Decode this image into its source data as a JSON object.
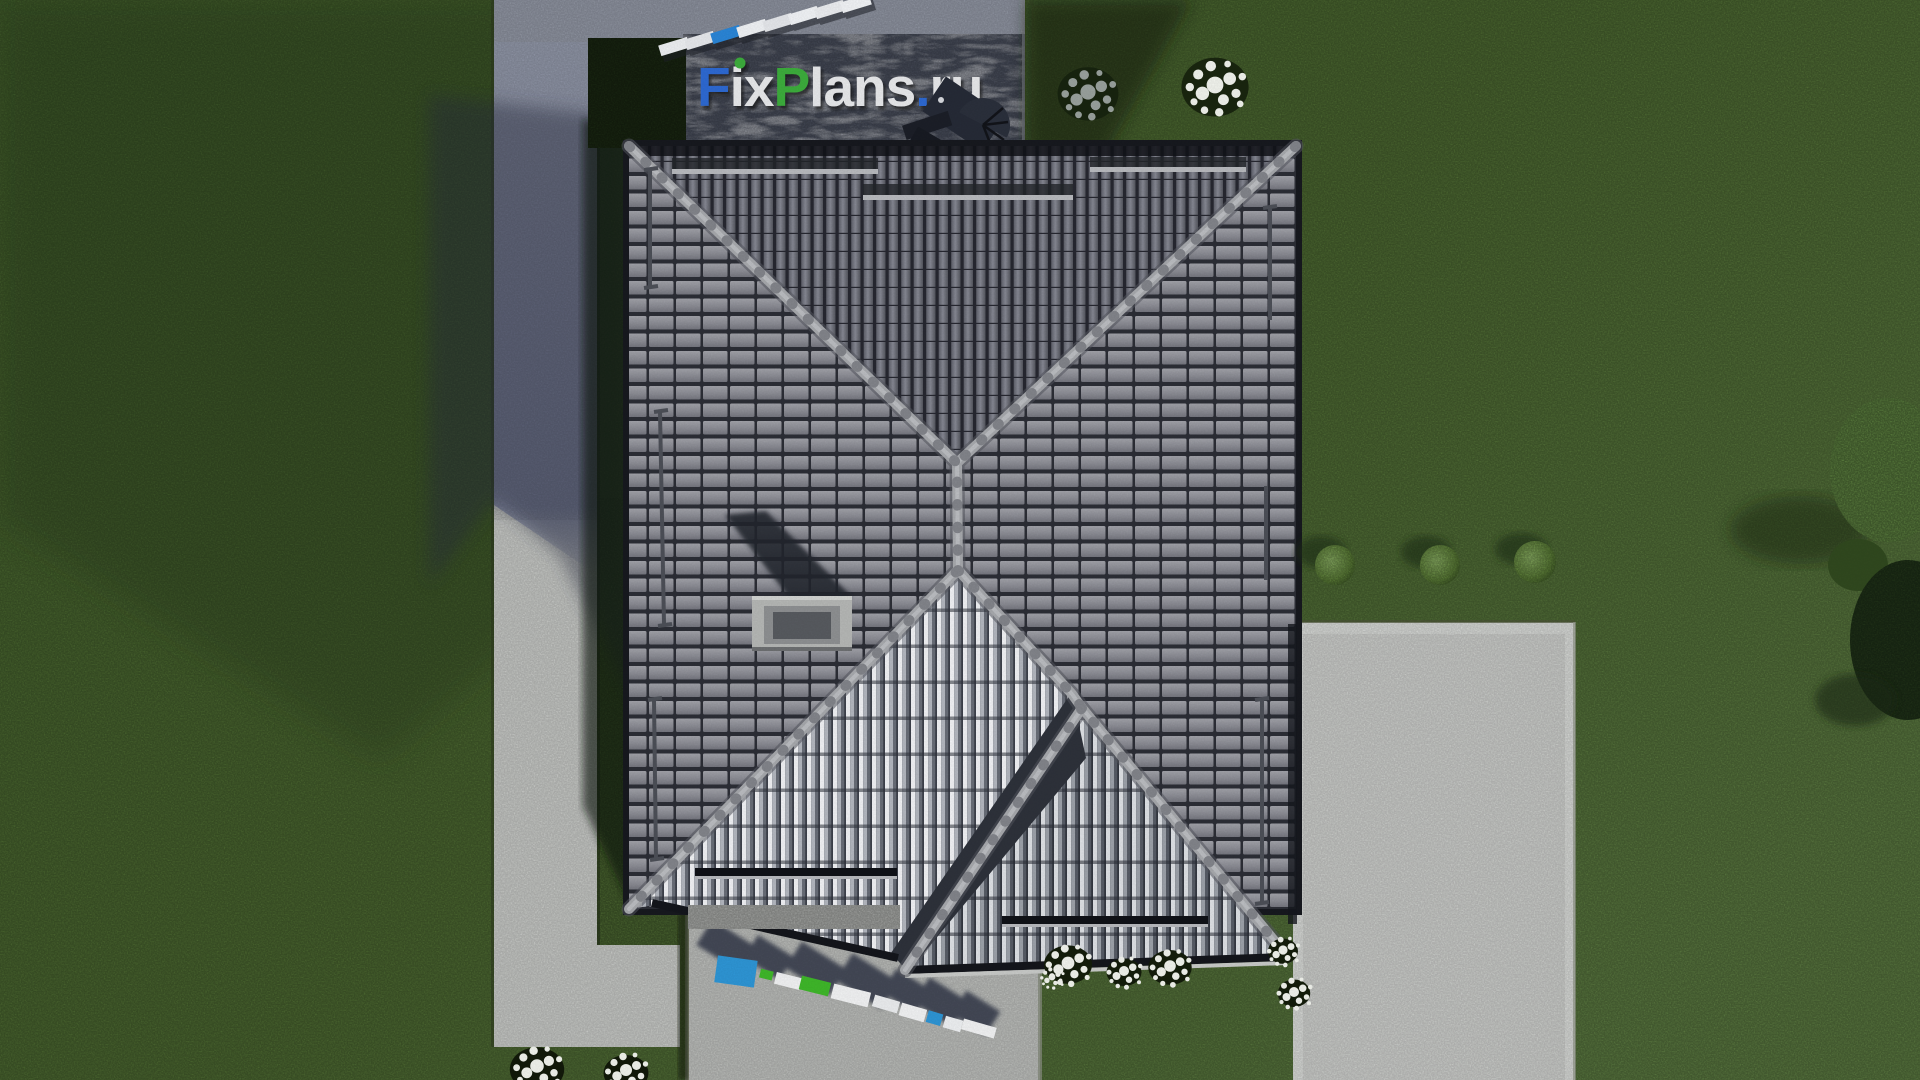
{
  "scene": {
    "description": "aerial top-down 3D render of a house hip roof with gray tiles, lawn, driveway, concrete pads and garden plants",
    "watermark_top": {
      "text": "FixPlans.ru",
      "segments": [
        {
          "text": "F",
          "color": "#2f6bd3"
        },
        {
          "text": "i",
          "color": "#e9eaec"
        },
        {
          "text": "x",
          "color": "#e9eaec"
        },
        {
          "text": "P",
          "color": "#3cae3c"
        },
        {
          "text": "lans",
          "color": "#e9eaec"
        },
        {
          "text": ".",
          "color": "#2f6bd3"
        },
        {
          "text": "ru",
          "color": "#e9eaec"
        }
      ]
    },
    "watermark_bottom": {
      "text": "FixPlans.ru",
      "style": "extruded tilted blocks lying on terrace with cast shadows",
      "block_colors": {
        "blue": "#2e96d6",
        "green": "#3fb82a",
        "white": "#f2f3f4"
      }
    },
    "palette": {
      "grass_lit": "#57743a",
      "grass_dark": "#43602c",
      "grass_shadow": "#16220f",
      "asphalt": "#8f94a4",
      "concrete": "#c6c8c5",
      "pad_concrete": "#cbcdca",
      "slate_terrace": "#454a57",
      "roof_tile": "#8e8f96",
      "roof_tile_gap": "#2c2e36",
      "roof_ridge": "#a8aaae",
      "gable_rib_light": "#f2f3f6",
      "logo_blue": "#2f6bd3",
      "logo_green": "#3cae3c"
    },
    "objects": [
      "hip roof with two front gables",
      "chimney with cast shadow",
      "snow guard rails",
      "stone terrace with logo",
      "plank walkway",
      "garden furniture",
      "three trimmed bushes",
      "white flower clusters",
      "edge trees"
    ]
  }
}
